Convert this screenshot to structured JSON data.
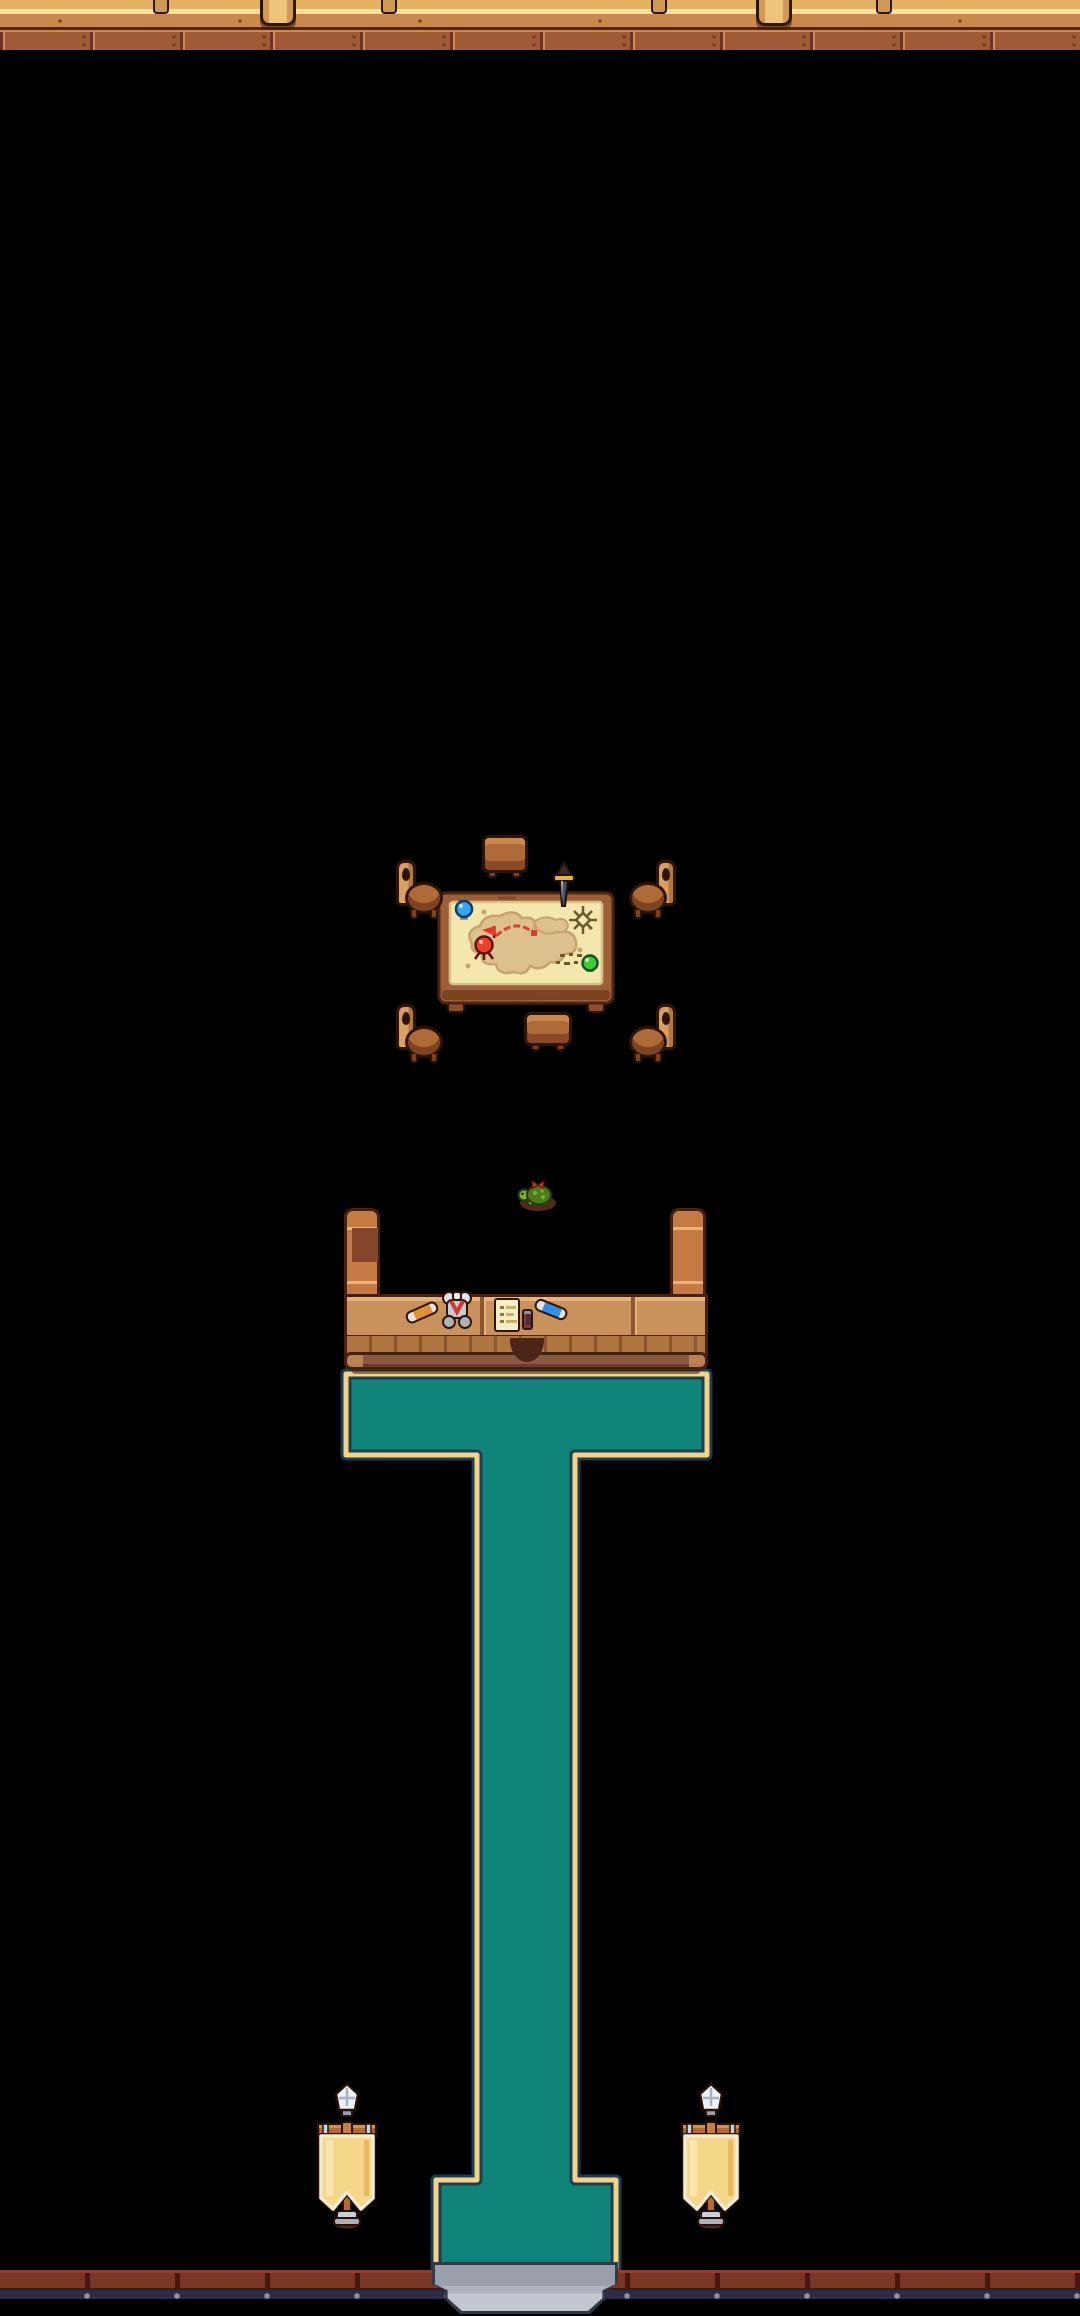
{
  "meta": {
    "scene_title": "Top-down pixel-art guild hall room",
    "view": "top-down tile map",
    "width_px": 1080,
    "height_px": 2316
  },
  "colors": {
    "plank": "#a05b36",
    "plank-light": "#c98e56",
    "seam": "#6f3222",
    "nail": "#7a4026",
    "outline": "#2e150c",
    "wall-tan": "#e3b263",
    "wall-cream": "#f8df9f",
    "wall-ledge": "#c9894c",
    "wall-ledge-dark": "#532517",
    "post": "#cf9a55",
    "post-light": "#ecc47c",
    "carpet-teal": "#0e8578",
    "carpet-gold": "#f2d484",
    "carpet-navy": "#1c3d55",
    "table-wood": "#9d6036",
    "table-dark": "#7c4322",
    "map-paper": "#f3e7ae",
    "map-land": "#dcc18d",
    "map-land-edge": "#c7a469",
    "pin-red": "#ee4128",
    "pin-blue": "#35a5f2",
    "pin-green": "#43cb37",
    "route-red": "#d94233",
    "compass": "#6d5a2e",
    "chair-light": "#d9a05e",
    "chair-mid": "#b06a38",
    "chair-dark": "#7e431f",
    "counter-top": "#c9915b",
    "counter-edge": "#e6b478",
    "counter-front": "#b0763f",
    "counter-groove": "#8a5730",
    "counter-arm": "#c57a43",
    "counter-outline": "#46200f",
    "banner-cloth": "#f5d78a",
    "banner-trim": "#f2ead5",
    "banner-wood": "#b26b35",
    "silver": "#ccd1d9",
    "silver-dark": "#8e939e",
    "trim-block": "#7b3524",
    "trim-dark": "#46180f",
    "bottom-navy": "#2b2d47",
    "stud": "#8d92a0",
    "step-gray": "#9aa0ab",
    "step-light": "#c3c7d0",
    "step-dark": "#333a47",
    "turtle-green": "#7fae2f",
    "turtle-shell": "#4e7a1e",
    "shadow-brown": "#55281a"
  },
  "objects": {
    "floor": {
      "label": "wooden plank floor"
    },
    "north_wall": {
      "label": "north wall ledge with furniture posts"
    },
    "map_table": {
      "label": "war table with treasure map",
      "map_pins": [
        "blue pin",
        "red pin",
        "green pin"
      ],
      "map_features": [
        "compass rose",
        "red dashed route",
        "red route flag",
        "red waypoint square",
        "landmasses",
        "tiny tree marks"
      ],
      "stuck_item": "dagger"
    },
    "chairs": {
      "label": "four wooden chairs",
      "count": 4
    },
    "stools": {
      "label": "two small wooden benches",
      "count": 2
    },
    "turtle": {
      "label": "pet turtle with red bow"
    },
    "counter": {
      "label": "reception counter",
      "items": [
        "orange wrapped scroll",
        "armor bundle with red plume",
        "paper list",
        "potion vial",
        "blue wrapped scroll"
      ]
    },
    "carpet": {
      "label": "teal runner carpet with gold border"
    },
    "banners": {
      "label": "two yellow wall banners with silver finials",
      "count": 2
    },
    "exit_step": {
      "label": "stone doorway step at south exit"
    }
  }
}
